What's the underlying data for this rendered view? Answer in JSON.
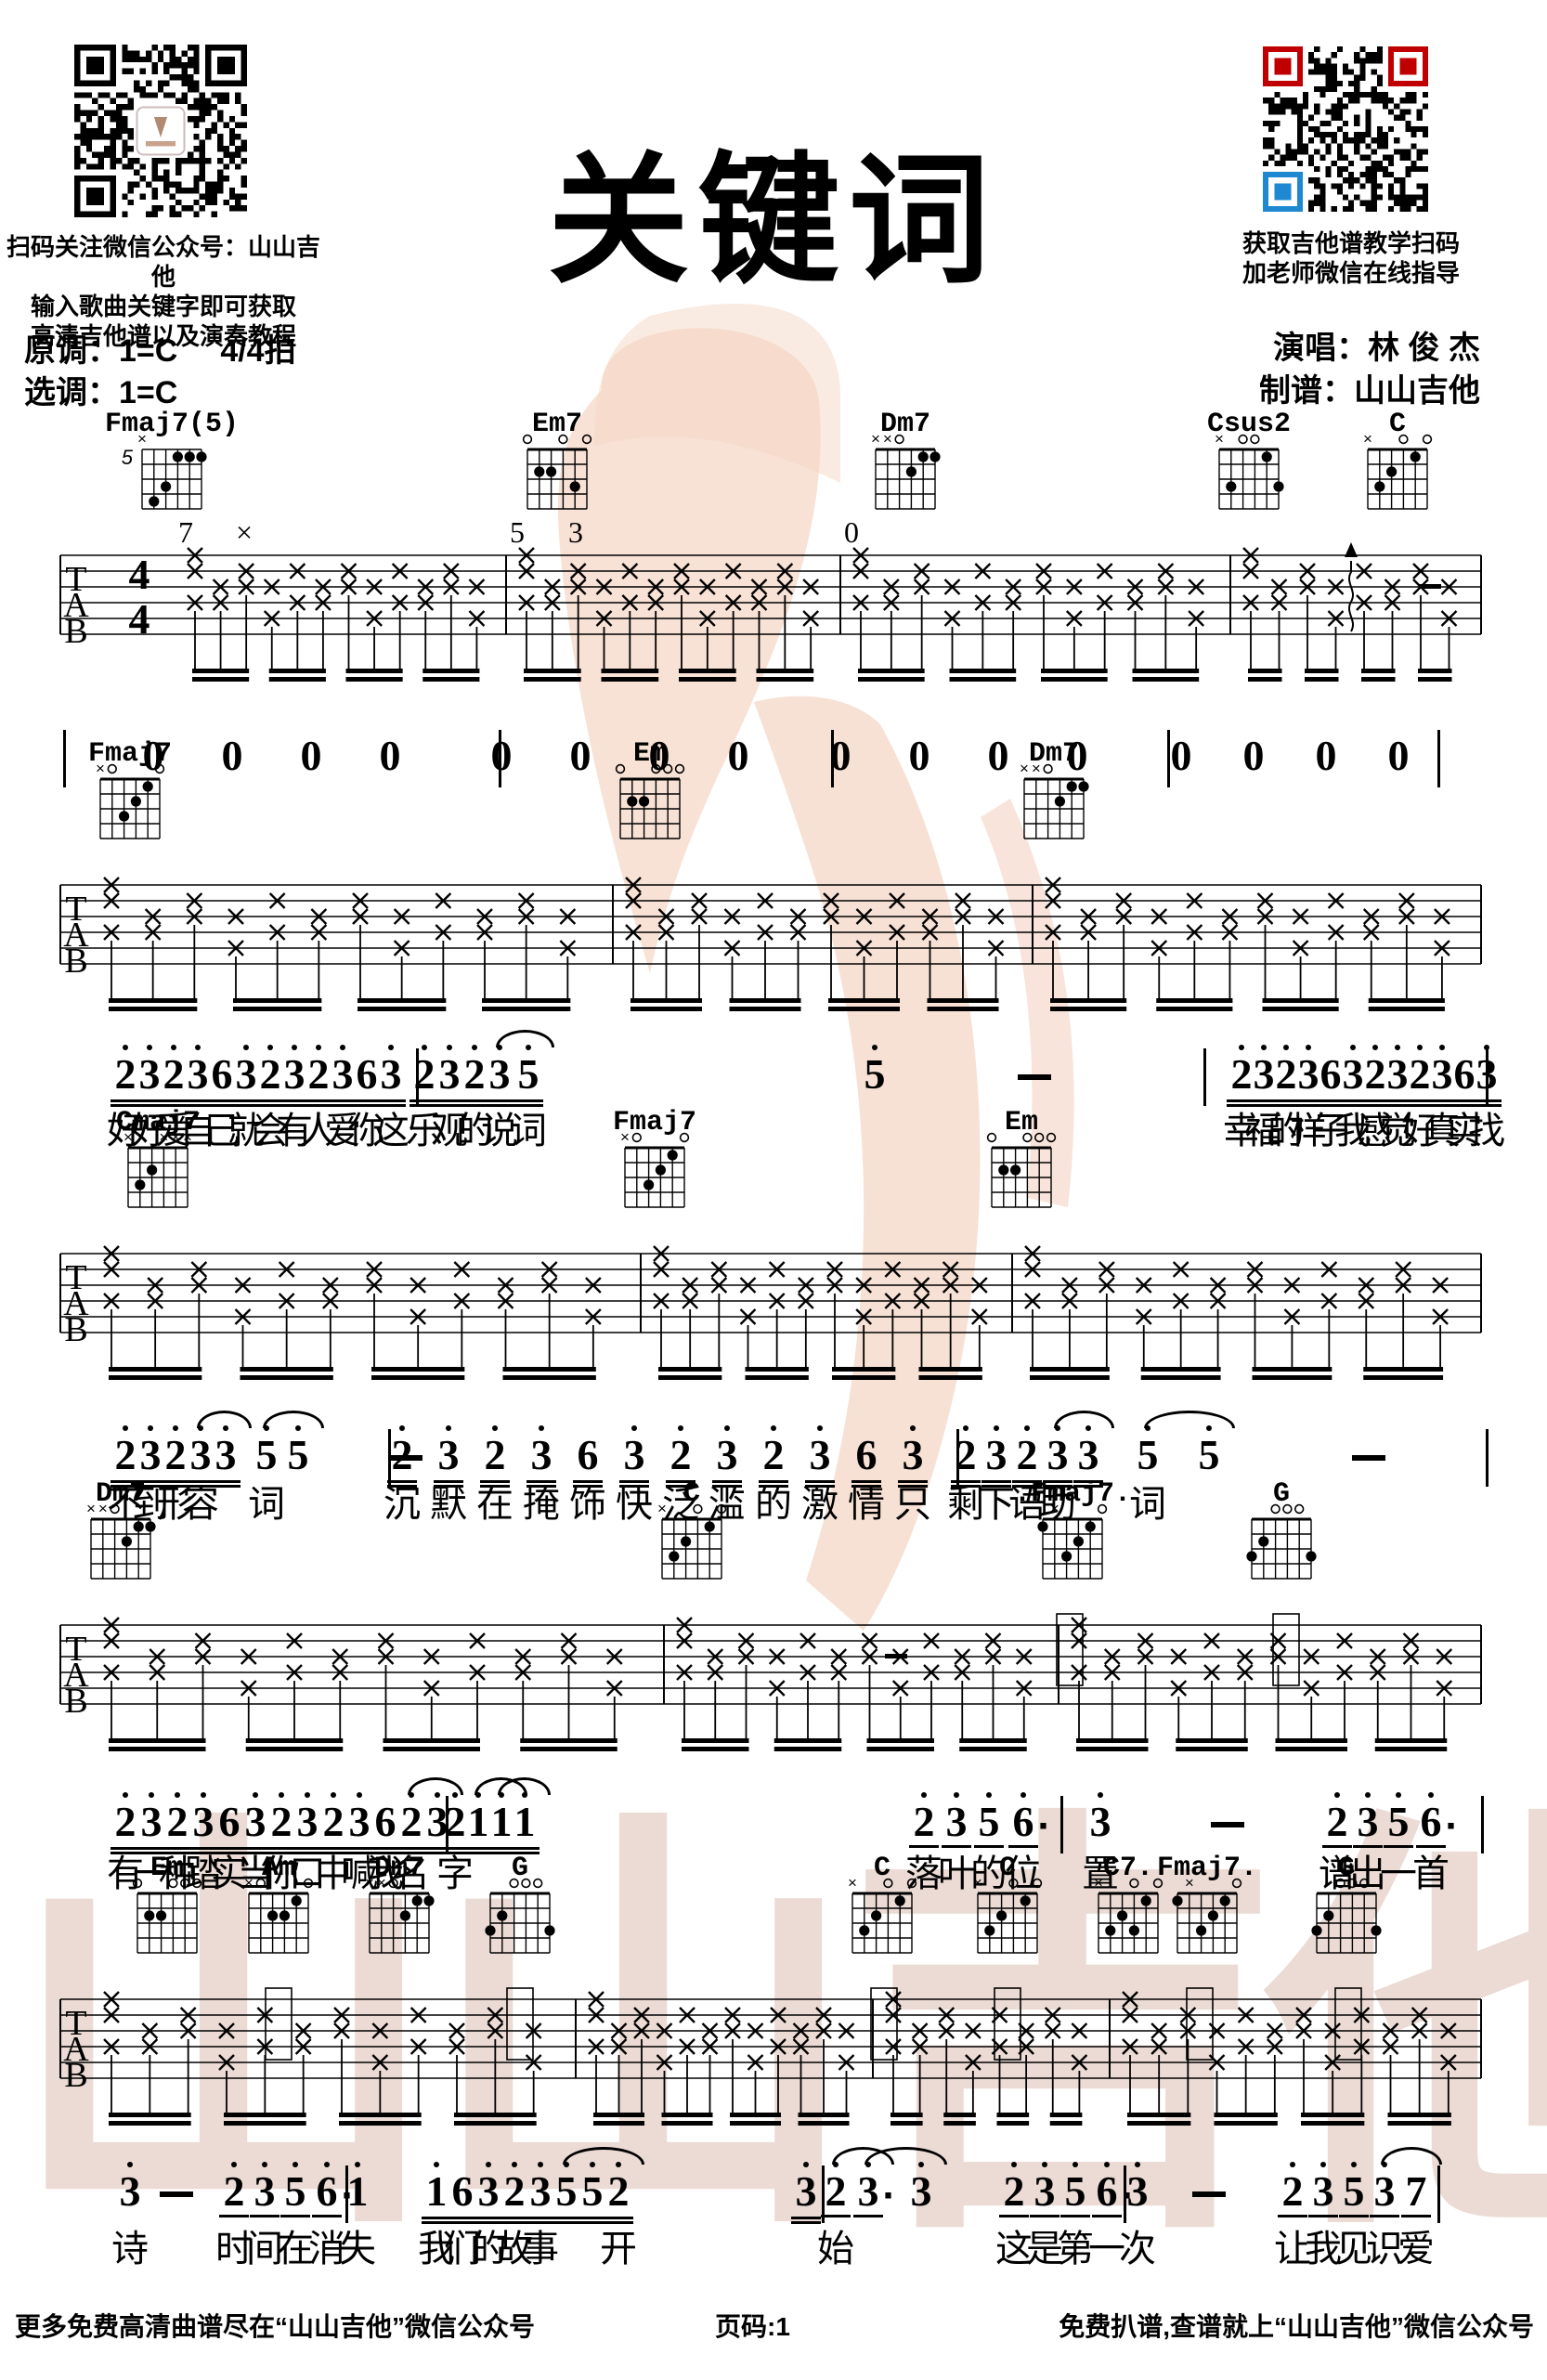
{
  "page": {
    "title": "关键词"
  },
  "header": {
    "qr_left_caption": [
      "扫码关注微信公众号：山山吉他",
      "输入歌曲关键字即可获取",
      "高清吉他谱以及演奏教程"
    ],
    "original_key": "原调：1=C",
    "beat": "4/4拍",
    "selected_key": "选调：1=C",
    "qr_right_caption": [
      "获取吉他谱教学扫码",
      "加老师微信在线指导"
    ],
    "singer": "演唱：林 俊 杰",
    "transcriber": "制谱：山山吉他"
  },
  "footer": {
    "left": "更多免费高清曲谱尽在“山山吉他”微信公众号",
    "page_no": "页码:1",
    "right": "免费扒谱,查谱就上“山山吉他”微信公众号"
  },
  "watermark_text": "山山吉他",
  "tab_header": {
    "letters": [
      "T",
      "A",
      "B"
    ],
    "time_signature": [
      "4",
      "4"
    ]
  },
  "chord_shapes": {
    "Fmaj7(5)": {
      "pos": "5",
      "top": [
        "x",
        "",
        "",
        "",
        "",
        ""
      ],
      "dots": [
        [
          3,
          1
        ],
        [
          2,
          1
        ],
        [
          1,
          1
        ],
        [
          4,
          3
        ],
        [
          5,
          4
        ]
      ]
    },
    "Em7": {
      "pos": "",
      "top": [
        "o",
        "",
        "",
        "o",
        "",
        "o"
      ],
      "dots": [
        [
          5,
          2
        ],
        [
          4,
          2
        ],
        [
          2,
          3
        ]
      ]
    },
    "Dm7": {
      "pos": "",
      "top": [
        "x",
        "x",
        "o",
        "",
        "",
        ""
      ],
      "dots": [
        [
          2,
          1
        ],
        [
          1,
          1
        ],
        [
          3,
          2
        ]
      ]
    },
    "Csus2": {
      "pos": "",
      "top": [
        "x",
        "",
        "o",
        "o",
        "",
        ""
      ],
      "dots": [
        [
          2,
          1
        ],
        [
          5,
          3
        ],
        [
          1,
          3
        ]
      ]
    },
    "C": {
      "pos": "",
      "top": [
        "x",
        "",
        "",
        "o",
        "",
        "o"
      ],
      "dots": [
        [
          5,
          3
        ],
        [
          4,
          2
        ],
        [
          2,
          1
        ]
      ]
    },
    "Fmaj7": {
      "pos": "",
      "top": [
        "x",
        "o",
        "",
        "",
        "",
        "o"
      ],
      "dots": [
        [
          2,
          1
        ],
        [
          3,
          2
        ],
        [
          4,
          3
        ]
      ]
    },
    "Em": {
      "pos": "",
      "top": [
        "o",
        "",
        "",
        "o",
        "o",
        "o"
      ],
      "dots": [
        [
          5,
          2
        ],
        [
          4,
          2
        ]
      ]
    },
    "Cmaj7": {
      "pos": "",
      "top": [
        "x",
        "",
        "",
        "x",
        "x",
        "x"
      ],
      "dots": [
        [
          5,
          3
        ],
        [
          4,
          2
        ]
      ]
    },
    "Fmaj7b": {
      "pos": "",
      "top": [
        "",
        "x",
        "",
        "",
        "",
        "o"
      ],
      "dots": [
        [
          6,
          1
        ],
        [
          2,
          1
        ],
        [
          3,
          2
        ],
        [
          4,
          3
        ]
      ]
    },
    "G": {
      "pos": "",
      "top": [
        "",
        "",
        "o",
        "o",
        "o",
        ""
      ],
      "dots": [
        [
          6,
          3
        ],
        [
          5,
          2
        ],
        [
          1,
          3
        ]
      ]
    },
    "Am": {
      "pos": "",
      "top": [
        "x",
        "o",
        "",
        "",
        "",
        "o"
      ],
      "dots": [
        [
          2,
          1
        ],
        [
          4,
          2
        ],
        [
          3,
          2
        ]
      ]
    },
    "C7": {
      "pos": "",
      "top": [
        "x",
        "",
        "",
        "o",
        "",
        "o"
      ],
      "dots": [
        [
          5,
          3
        ],
        [
          4,
          2
        ],
        [
          3,
          3
        ],
        [
          2,
          1
        ]
      ]
    }
  },
  "systems": [
    {
      "chords": [
        {
          "label": "Fmaj7(5)",
          "shape": "Fmaj7(5)"
        },
        {
          "label": "Em7",
          "shape": "Em7"
        },
        {
          "label": "Dm7",
          "shape": "Dm7"
        },
        {
          "label": "Csus2",
          "shape": "Csus2"
        },
        {
          "label": "C",
          "shape": "C"
        }
      ],
      "annotations": [
        "7",
        "×",
        "5",
        "3",
        "0"
      ],
      "melody": [
        {
          "tokens": [
            "0:",
            "0:",
            "0:",
            "0:"
          ],
          "lyric": ""
        },
        {
          "tokens": [
            "0:",
            "0:",
            "0:",
            "0:"
          ],
          "lyric": ""
        },
        {
          "tokens": [
            "0:",
            "0:",
            "0:",
            "0:"
          ],
          "lyric": ""
        },
        {
          "tokens": [
            "0:",
            "0:",
            "0:",
            "0:"
          ],
          "lyric": ""
        }
      ]
    },
    {
      "chords": [
        {
          "label": "Fmaj7",
          "shape": "Fmaj7"
        },
        {
          "label": "Em",
          "shape": "Em"
        },
        {
          "label": "Dm7",
          "shape": "Dm7"
        }
      ],
      "annotations": [],
      "melody": [
        {
          "tokens": [
            "2:h2",
            "3:h2",
            "2:h2",
            "3:h2",
            "6:2",
            "3:h2",
            "2:h2",
            "3:h2",
            "2:h2",
            "3:h2",
            "6:2",
            "3:h2"
          ],
          "lyric": "好好爱自己就会有人爱你这"
        },
        {
          "tokens": [
            "2:h2",
            "3:h2",
            "2:h2",
            "3:h2",
            "5:h2",
            "5:h0",
            "—:"
          ],
          "lyric": "乐观的说词"
        },
        {
          "tokens": [
            "2:h2",
            "3:h2",
            "2:h2",
            "3:h2",
            "6:2",
            "3:h2",
            "2:h2",
            "3:h2",
            "2:h2",
            "3:h2",
            "6:2",
            "3:h2"
          ],
          "lyric": "幸福的样子我感觉好真实找"
        }
      ]
    },
    {
      "chords": [
        {
          "label": "Cmaj7",
          "shape": "Cmaj7"
        },
        {
          "label": "Fmaj7",
          "shape": "Fmaj7"
        },
        {
          "label": "Em",
          "shape": "Em"
        }
      ],
      "annotations": [],
      "melody": [
        {
          "tokens": [
            "2:h2",
            "3:h2",
            "2:h2",
            "3:h2",
            "3:h2",
            "5:h0",
            "5:h0",
            "—:"
          ],
          "lyric": "不到形容词"
        },
        {
          "tokens": [
            "2:h2",
            "3:h2",
            "2:h2",
            "3:h2",
            "6:2",
            "3:h2",
            "2:h2",
            "3:h2",
            "2:h2",
            "3:h2",
            "6:2",
            "3:h2"
          ],
          "lyric": "沉默在掩饰快泛滥的激情只"
        },
        {
          "tokens": [
            "2:h2",
            "3:h2",
            "2:h2",
            "3:h2",
            "3:h2",
            "5:h0",
            "5:h0",
            "—:"
          ],
          "lyric": "剩下语助词"
        }
      ]
    },
    {
      "chords": [
        {
          "label": "Dm7",
          "shape": "Dm7"
        },
        {
          "label": "C",
          "shape": "C"
        },
        {
          "label": ".Fmaj7.",
          "shape": "Fmaj7b"
        },
        {
          "label": "G",
          "shape": "G"
        }
      ],
      "annotations": [],
      "melody": [
        {
          "tokens": [
            "2:h2",
            "3:h2",
            "2:h2",
            "3:h2",
            "6:2",
            "3:h2",
            "2:h2",
            "3:h2",
            "2:h2",
            "3:h2",
            "6:2",
            "2:h2",
            "3:h2"
          ],
          "lyric": "有一种踏实当你口中喊我名"
        },
        {
          "tokens": [
            "2:h2",
            "1:h2",
            "1:h2",
            "1:h2",
            "2:h1",
            "3:h1",
            "5:h1",
            "6:h1d"
          ],
          "lyric": "字落叶的位"
        },
        {
          "tokens": [
            "3:h0",
            "—:",
            "2:h1",
            "3:h1",
            "5:h1",
            "6:h1d"
          ],
          "lyric": "置谱出一首"
        }
      ]
    },
    {
      "chords": [
        {
          "label": "Em",
          "shape": "Em"
        },
        {
          "label": "Am",
          "shape": "Am"
        },
        {
          "label": "Dm7",
          "shape": "Dm7"
        },
        {
          "label": "G",
          "shape": "G"
        },
        {
          "label": "C",
          "shape": "C"
        },
        {
          "label": "C",
          "shape": "C"
        },
        {
          "label": "C7.",
          "shape": "C7"
        },
        {
          "label": "Fmaj7.",
          "shape": "Fmaj7b"
        },
        {
          "label": "G",
          "shape": "G"
        }
      ],
      "annotations": [],
      "melody": [
        {
          "tokens": [
            "3:h0",
            "—:",
            "2:h1",
            "3:h1",
            "5:h1",
            "6:h1d"
          ],
          "lyric": "诗时间在消"
        },
        {
          "tokens": [
            "1:h0",
            "1:h2",
            "6:2",
            "3:h2",
            "2:h2",
            "3:h2",
            "5:h2",
            "5:h2",
            "2:h2",
            "3:h2"
          ],
          "lyric": "失我们的故事开"
        },
        {
          "tokens": [
            "2:h1",
            "3:h1d",
            "3:h0",
            "2:h1",
            "3:h1",
            "5:h1",
            "6:h1d"
          ],
          "lyric": "始这是第一"
        },
        {
          "tokens": [
            "3:h0",
            "—:",
            "2:h1",
            "3:h1",
            "5:h1",
            "3:h1",
            "7:1"
          ],
          "lyric": "次让我见识爱"
        }
      ]
    }
  ]
}
